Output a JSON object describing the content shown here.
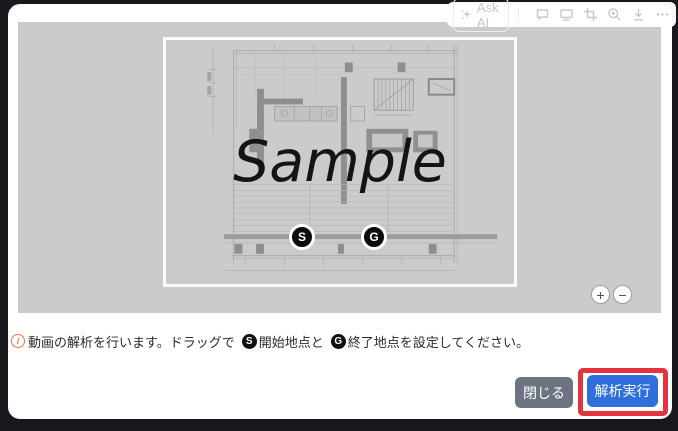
{
  "toolbar": {
    "ask_ai_label": "Ask AI",
    "icons": [
      "sparkle-icon",
      "comment-icon",
      "display-icon",
      "crop-icon",
      "zoom-in-icon",
      "download-icon",
      "more-icon"
    ]
  },
  "viewer": {
    "watermark": "Sample",
    "start_marker": "S",
    "goal_marker": "G",
    "zoom_in_label": "+",
    "zoom_out_label": "−"
  },
  "instruction": {
    "info_icon": "i",
    "part1": "動画の解析を行います。ドラッグで",
    "start_badge": "S",
    "part2": "開始地点と",
    "goal_badge": "G",
    "part3": "終了地点を設定してください。"
  },
  "footer": {
    "close_label": "閉じる",
    "run_label": "解析実行"
  },
  "colors": {
    "backdrop": "#17191c",
    "viewer_bg": "#cbcbcb",
    "run_button": "#2e6fdb",
    "close_button": "#6b7480",
    "annotation": "#e13440",
    "info_icon": "#e8764a"
  }
}
